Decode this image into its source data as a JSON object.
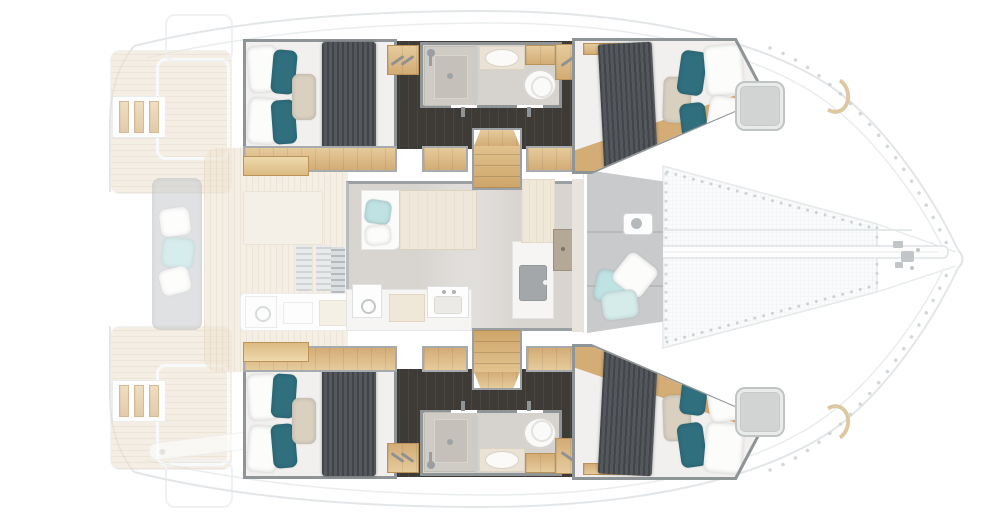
{
  "vessel": {
    "type": "sailing catamaran interior deck plan",
    "view": "top-down, bow to the right, two mirrored hulls",
    "cabin_count": 4,
    "bathroom_count": 2,
    "regions": {
      "sternDeck": "aft deck with twin teak swim platforms, boarding ladder and engine hatches",
      "aftCockpit": "aft cockpit with lounge sofa, scatter cushions, coffee table, vents and galley module",
      "saloon": "saloon with settee, dining table, galley counter with sink and cooktop island, mast cabinet",
      "forwardCockpit": "forward cockpit sunpad with aqua and white scatter cushions and deck fitting",
      "trampoline": "bow trampoline net laced to hulls with central bowsprit beam and anchor fittings",
      "hullPort": "upper hull: aft double cabin with teal pillows, dark corridor sole, bathroom with shower, washbasin and toilet, companionway stairs, forward double cabin, deck hatch",
      "hullStarboard": "lower hull (mirror of upper): aft double cabin, bathroom with shower, washbasin and toilet, companionway stairs, forward double cabin, deck hatch"
    },
    "fixtures_per_bathroom": [
      "shower cabin with drain",
      "washbasin on counter",
      "marine toilet",
      "storage cabinet"
    ]
  },
  "colors": {
    "outline": "#e3e6e8",
    "wall": "#8f9497",
    "wallMid": "#a8abad",
    "teak": "#efe5d4",
    "teakStripe": "#e2d5c0",
    "saloonFloor": "#d8d5d1",
    "corridor": "#e8e4dd",
    "darkFloor": "#3e3a36",
    "darkLine": "#332f2b",
    "wood": "#d3ac76",
    "woodDark": "#bb9257",
    "woodLight": "#e6cb9b",
    "woodPale": "#efe7d8",
    "mattress": "#f1f0ee",
    "blanket": "#54575b",
    "blanketDark": "#42454a",
    "teal": "#2f6f7e",
    "tealLight": "#bfe2e2",
    "beige": "#d9d0c0",
    "bathFloor": "#d6d3ce",
    "showerTray": "#cfcbc5",
    "showerInner": "#c5c1ba",
    "fixture": "#fafaf9",
    "fixtureLine": "#d8d6d2",
    "hatch": "#d2d4d4",
    "hatchRim": "#c0c4c4",
    "cushion": "#c8cacb",
    "cushionSeam": "#b7babb",
    "sofa": "#cdd0d2",
    "tableTop": "#efe7d9",
    "counter": "#f6f5f3",
    "sinkDark": "#a3a7a9",
    "hardware": "#c2c6c9",
    "net": "#fafbfb",
    "netLine": "#eceff1",
    "beam": "#fdfdfd",
    "lace": "#c6cbce"
  }
}
